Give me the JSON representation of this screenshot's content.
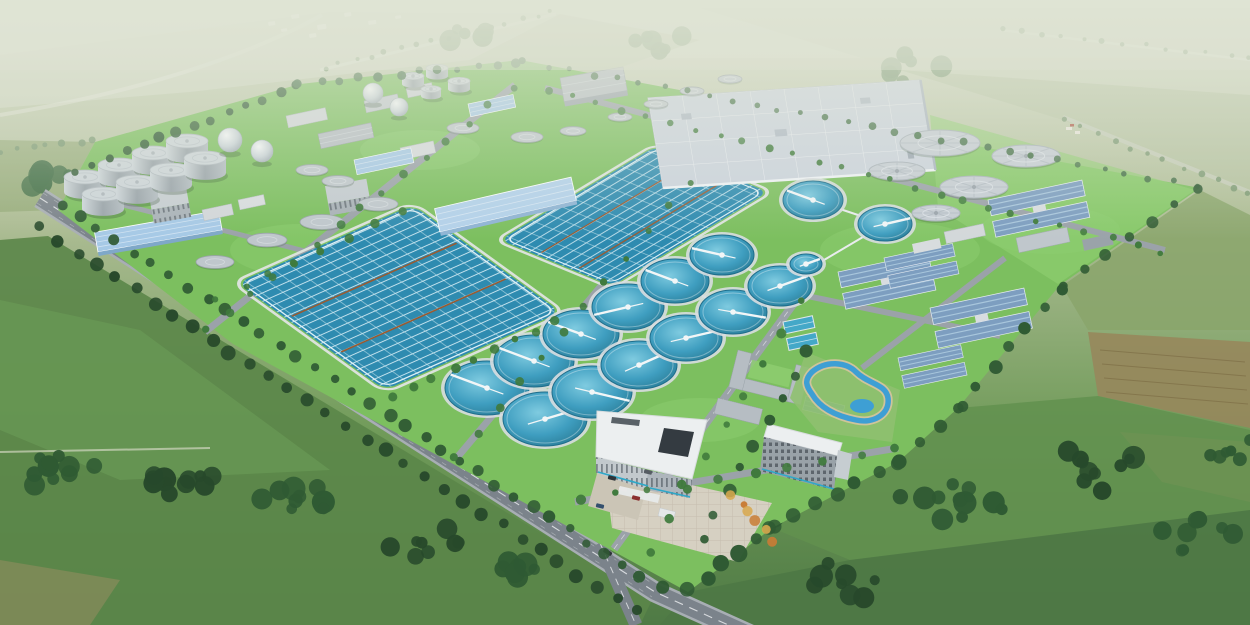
{
  "meta": {
    "description": "Aerial architectural rendering of a large wastewater treatment plant campus set in green farmland: sludge digester cylinders and gas-holder spheres at upper left, two large rectangular aeration basins with lane grids, a field of circular clarifier tanks, a big covered flat-roof facility, blue-roofed process buildings, covered gray circular tanks, a white-roofed administration complex with plaza and landscaped pond, tree-lined perimeter roads and surrounding fields"
  },
  "palette": {
    "skyTop": "#d6dbc9",
    "fieldLight": "#9db27e",
    "fieldMid": "#7da061",
    "fieldDeep": "#5d8549",
    "fieldDark": "#4f7647",
    "forest": "#2f5a33",
    "forestLight": "#47724a",
    "forestDark": "#27492b",
    "treeBright": "#3f7a3c",
    "treeAccent": "#d9a84e",
    "treeAccent2": "#c97c35",
    "distantTree": "#7d9a74",
    "siteLawn": "#7cbf5f",
    "siteLawnLight": "#8fce70",
    "roadOuter": "#7b838b",
    "roadInner": "#9ba2a9",
    "roadLine": "#e8eaec",
    "basinWater": "#2e8bb0",
    "basinLane": "#cfe9f2",
    "basinDivider": "#9a5a30",
    "clarifierRim": "#d8dde0",
    "tankGray": "#aab3b9",
    "tankGrayTop": "#c6cdd4",
    "tankDark": "#8b949b",
    "roofWhite": "#eceff0",
    "roofBlue": "#a6c9e6",
    "roofBlueDark": "#7d9ec0",
    "roofStripe": "#a8c6dc",
    "bldgGray": "#b6bdc3",
    "bldgWhite": "#d3d8da",
    "facade": "#9aa3a9",
    "plaza": "#d6d0c2",
    "pondBlue": "#3e9fd4",
    "sand": "#cfc49a",
    "brownField": "#97875c",
    "brownFieldDark": "#7a6a42",
    "cyan": "#2fa8c8"
  },
  "scene": {
    "clarifiers": [
      [
        487,
        388,
        42,
        27,
        -150
      ],
      [
        545,
        419,
        42,
        27,
        -25
      ],
      [
        534,
        361,
        40,
        26,
        -150
      ],
      [
        592,
        392,
        40,
        26,
        20
      ],
      [
        581,
        334,
        38,
        24,
        -150
      ],
      [
        639,
        365,
        38,
        24,
        -35
      ],
      [
        628,
        307,
        36,
        23,
        160
      ],
      [
        686,
        338,
        36,
        23,
        -20
      ],
      [
        675,
        281,
        34,
        22,
        -150
      ],
      [
        733,
        312,
        34,
        22,
        15
      ],
      [
        722,
        255,
        32,
        20,
        -160
      ],
      [
        780,
        286,
        32,
        20,
        -30
      ],
      [
        813,
        200,
        30,
        19,
        -150
      ],
      [
        885,
        224,
        27,
        17,
        -20
      ],
      [
        806,
        264,
        16,
        10,
        -30
      ]
    ],
    "covered_tanks": [
      [
        940,
        143,
        40,
        13
      ],
      [
        1026,
        156,
        34,
        11
      ],
      [
        897,
        171,
        28,
        9
      ],
      [
        974,
        187,
        34,
        11
      ],
      [
        936,
        213,
        24,
        8
      ]
    ],
    "small_tanks": [
      [
        620,
        117,
        12
      ],
      [
        656,
        104,
        12
      ],
      [
        692,
        91,
        12
      ],
      [
        730,
        79,
        12
      ],
      [
        573,
        131,
        13
      ],
      [
        463,
        128,
        16
      ],
      [
        527,
        137,
        16
      ],
      [
        312,
        170,
        16
      ],
      [
        338,
        181,
        16
      ],
      [
        215,
        262,
        19
      ],
      [
        267,
        240,
        20
      ],
      [
        322,
        222,
        22
      ],
      [
        378,
        204,
        20
      ]
    ],
    "digesters": [
      [
        85,
        192,
        21,
        15
      ],
      [
        119,
        180,
        21,
        15
      ],
      [
        153,
        168,
        21,
        15
      ],
      [
        187,
        156,
        21,
        15
      ],
      [
        103,
        209,
        21,
        15
      ],
      [
        137,
        197,
        21,
        15
      ],
      [
        171,
        185,
        21,
        15
      ],
      [
        205,
        173,
        21,
        15
      ],
      [
        413,
        84,
        11,
        8
      ],
      [
        437,
        76,
        11,
        8
      ],
      [
        459,
        89,
        11,
        8
      ],
      [
        431,
        96,
        10,
        7
      ]
    ],
    "spheres": [
      [
        230,
        140,
        12
      ],
      [
        262,
        151,
        11
      ],
      [
        373,
        93,
        10
      ],
      [
        399,
        107,
        9
      ]
    ],
    "village_houses": [
      [
        268,
        22,
        7,
        4
      ],
      [
        291,
        15,
        8,
        4
      ],
      [
        317,
        25,
        9,
        5
      ],
      [
        344,
        13,
        7,
        4
      ],
      [
        368,
        21,
        8,
        4
      ],
      [
        395,
        16,
        6,
        3
      ],
      [
        309,
        34,
        7,
        4
      ],
      [
        281,
        29,
        6,
        3
      ]
    ],
    "farm_buildings": [
      [
        1066,
        127,
        6,
        3
      ],
      [
        1075,
        131,
        5,
        3
      ]
    ],
    "cars_highway": [
      {
        "t": 0.18,
        "o": -1,
        "c": "#2e3338"
      },
      {
        "t": 0.33,
        "o": 1,
        "c": "#e8e8e8"
      },
      {
        "t": 0.47,
        "o": -1,
        "c": "#8a2f2f"
      },
      {
        "t": 0.62,
        "o": 1,
        "c": "#34506e"
      },
      {
        "t": 0.75,
        "o": -1,
        "c": "#e8e8e8"
      },
      {
        "t": 0.88,
        "o": 1,
        "c": "#2e3338"
      }
    ],
    "cars_plaza": [
      [
        612,
        478
      ],
      [
        623,
        489
      ],
      [
        636,
        498
      ],
      [
        600,
        506
      ],
      [
        648,
        472
      ]
    ],
    "pipes": [
      [
        487,
        388,
        722,
        255
      ],
      [
        545,
        419,
        780,
        286
      ],
      [
        487,
        388,
        545,
        419
      ],
      [
        534,
        361,
        592,
        392
      ],
      [
        581,
        334,
        639,
        365
      ],
      [
        628,
        307,
        686,
        338
      ],
      [
        675,
        281,
        733,
        312
      ],
      [
        722,
        255,
        780,
        286
      ],
      [
        780,
        286,
        885,
        224
      ],
      [
        813,
        200,
        885,
        224
      ]
    ],
    "tree_rows": [
      [
        75,
        172,
        298,
        86,
        14,
        4.5,
        "forest"
      ],
      [
        300,
        84,
        518,
        62,
        12,
        4,
        "forestLight"
      ],
      [
        525,
        62,
        1195,
        186,
        30,
        3.2,
        "forestLight"
      ],
      [
        1198,
        190,
        1062,
        286,
        7,
        5,
        "forest"
      ],
      [
        1060,
        288,
        960,
        406,
        7,
        6,
        "forest"
      ],
      [
        958,
        408,
        900,
        460,
        4,
        6.5,
        "forest"
      ],
      [
        898,
        462,
        774,
        526,
        7,
        7,
        "forest"
      ],
      [
        772,
        528,
        690,
        590,
        6,
        7,
        "forest"
      ],
      [
        62,
        206,
        660,
        588,
        34,
        5.5,
        "forest"
      ],
      [
        38,
        228,
        636,
        612,
        32,
        6,
        "forestDark"
      ],
      [
        208,
        330,
        512,
        88,
        15,
        3.8,
        "treeBright"
      ],
      [
        456,
        458,
        688,
        182,
        12,
        3.8,
        "treeBright"
      ],
      [
        652,
        552,
        800,
        300,
        9,
        4.2,
        "treeBright"
      ],
      [
        548,
        90,
        1160,
        252,
        26,
        3.2,
        "treeBright"
      ],
      [
        578,
        500,
        895,
        450,
        10,
        4.2,
        "treeBright"
      ],
      [
        702,
        538,
        806,
        352,
        9,
        5.5,
        "forest"
      ],
      [
        392,
        398,
        556,
        322,
        9,
        4,
        "treeBright"
      ],
      [
        218,
        300,
        400,
        212,
        8,
        3.8,
        "treeBright"
      ],
      [
        325,
        68,
        552,
        12,
        16,
        2.5,
        "distantTree"
      ],
      [
        1000,
        28,
        1250,
        58,
        13,
        2.5,
        "distantTree"
      ],
      [
        0,
        152,
        95,
        140,
        7,
        3,
        "distantTree"
      ],
      [
        733,
        494,
        774,
        540,
        6,
        4.5,
        "treeAccent"
      ],
      [
        1063,
        120,
        1250,
        195,
        12,
        2.8,
        "distantTree"
      ]
    ],
    "tree_clumps": [
      [
        60,
        470,
        10,
        55,
        "forest"
      ],
      [
        180,
        482,
        12,
        60,
        "forestDark"
      ],
      [
        300,
        502,
        10,
        50,
        "forest"
      ],
      [
        420,
        542,
        8,
        45,
        "forestDark"
      ],
      [
        520,
        575,
        7,
        40,
        "forest"
      ],
      [
        950,
        500,
        12,
        70,
        "forest"
      ],
      [
        1090,
        468,
        10,
        60,
        "forestDark"
      ],
      [
        1200,
        538,
        8,
        50,
        "forest"
      ],
      [
        845,
        582,
        8,
        55,
        "forestDark"
      ],
      [
        1230,
        455,
        6,
        35,
        "forest"
      ],
      [
        40,
        185,
        9,
        42,
        "forestLight"
      ],
      [
        130,
        163,
        9,
        42,
        "forestLight"
      ],
      [
        228,
        134,
        9,
        40,
        "forestLight"
      ],
      [
        326,
        106,
        7,
        36,
        "forestLight"
      ],
      [
        1080,
        250,
        5,
        30,
        "treeBright"
      ],
      [
        760,
        512,
        8,
        30,
        "forest"
      ],
      [
        660,
        40,
        6,
        40,
        "distantTree"
      ],
      [
        900,
        70,
        6,
        45,
        "distantTree"
      ],
      [
        480,
        30,
        5,
        35,
        "distantTree"
      ],
      [
        850,
        395,
        7,
        26,
        "forest"
      ],
      [
        835,
        415,
        5,
        18,
        "treeAccent"
      ]
    ],
    "lawn_patches": [
      [
        300,
        250,
        70,
        26
      ],
      [
        700,
        420,
        60,
        22
      ],
      [
        900,
        250,
        80,
        28
      ],
      [
        420,
        150,
        60,
        20
      ],
      [
        1050,
        230,
        70,
        24
      ]
    ]
  }
}
